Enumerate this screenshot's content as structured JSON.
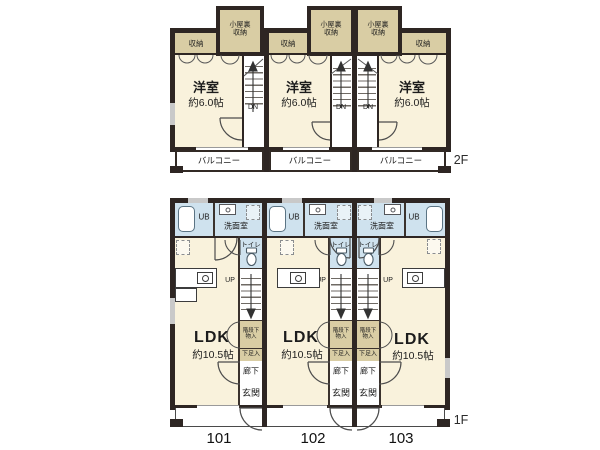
{
  "title": "2-story 3-unit apartment floor plan",
  "colors": {
    "wall": "#2e2623",
    "room": "#f9f2dc",
    "storage": "#d9cda4",
    "bath": "#cfe2ee"
  },
  "floor2": {
    "floor_label": "2F",
    "attic_line1": "小屋裏",
    "attic_line2": "収納",
    "closet": "収納",
    "room": "洋室",
    "room_size": "約6.0帖",
    "stairs": "DN",
    "balcony": "バルコニー"
  },
  "floor1": {
    "floor_label": "1F",
    "ub": "UB",
    "washroom": "洗面室",
    "toilet": "トイレ",
    "stairs": "UP",
    "understairs_line1": "階段下",
    "understairs_line2": "物入",
    "shoe_box": "下足入",
    "hallway": "廊下",
    "entrance": "玄関",
    "ldk": "LDK",
    "ldk_size": "約10.5帖",
    "unit_numbers": [
      "101",
      "102",
      "103"
    ]
  }
}
